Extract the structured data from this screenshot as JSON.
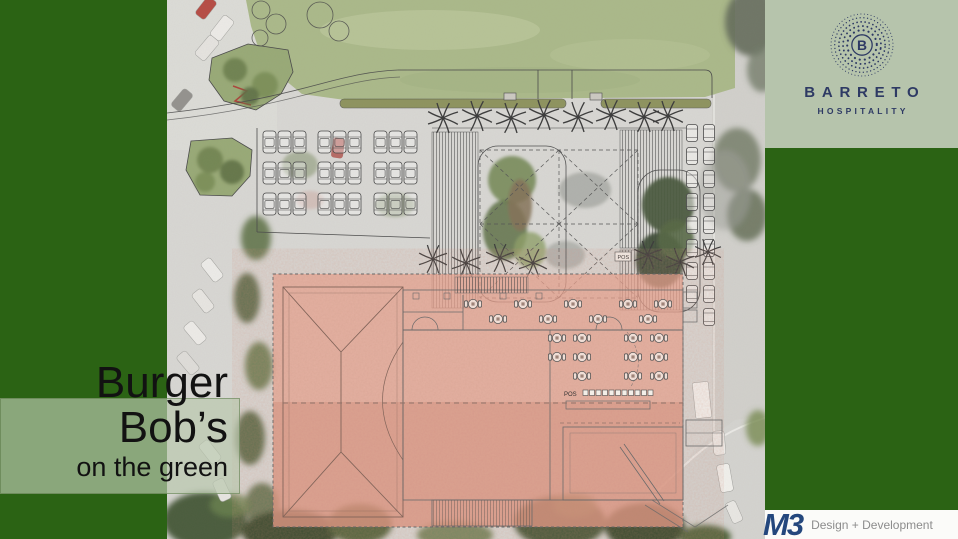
{
  "title": {
    "line1": "Burger",
    "line2": "Bob’s",
    "line3": "on the green"
  },
  "barreto": {
    "monogram": "B",
    "name": "BARRETO",
    "tagline": "HOSPITALITY"
  },
  "m3": {
    "logo": "M3",
    "tagline": "Design + Development"
  },
  "site_plan": {
    "pos_plaza": "POS",
    "pos_counter": "POS"
  },
  "colors": {
    "slide_green": "#2b6314",
    "sage_panel": "#b6c4ac",
    "barreto_navy": "#2e3a64",
    "m3_navy": "#24477d",
    "building_salmon": "#e89b87",
    "lawn_green": "#a6b583",
    "tagline_gray": "#8c8c8c"
  }
}
